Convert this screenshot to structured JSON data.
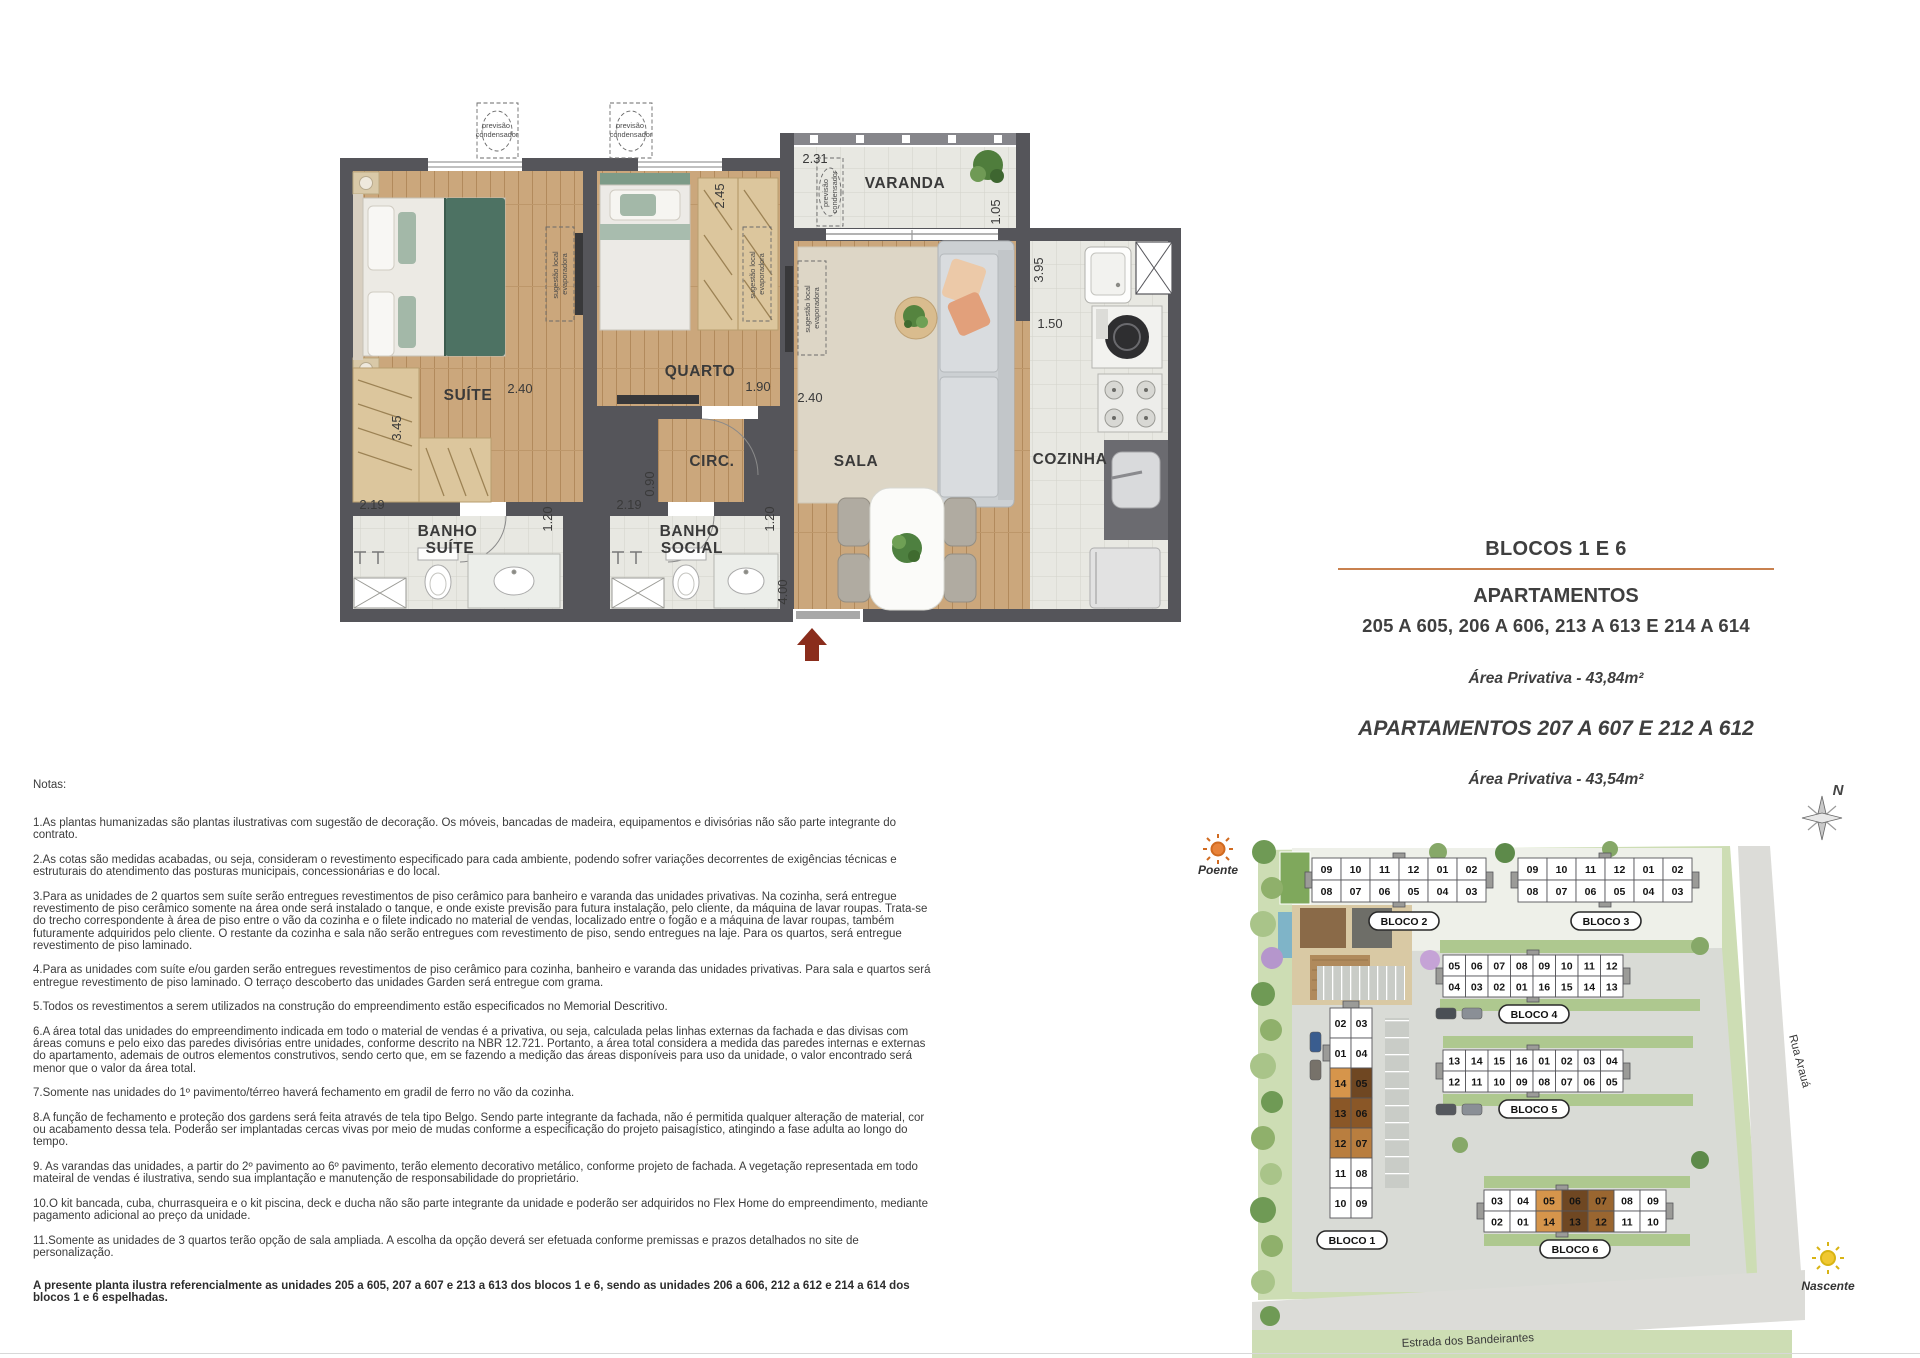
{
  "floorplan": {
    "rooms": {
      "suite": "SUÍTE",
      "quarto": "QUARTO",
      "circ": "CIRC.",
      "sala": "SALA",
      "cozinha": "COZINHA",
      "varanda": "VARANDA",
      "banho_suite": [
        "BANHO",
        "SUÍTE"
      ],
      "banho_social": [
        "BANHO",
        "SOCIAL"
      ]
    },
    "dims": {
      "varanda_width": "2.31",
      "varanda_depth": "1.05",
      "cozinha_depth": "3.95",
      "cozinha_width": "1.50",
      "quarto_depth": "2.45",
      "suite_width": "2.40",
      "suite_depth": "3.45",
      "quarto_width": "1.90",
      "sala_width": "2.40",
      "circ_width": "0.90",
      "banho_suite_width": "2.19",
      "banho_suite_depth": "1.20",
      "banho_social_width": "2.19",
      "banho_social_depth": "1.20",
      "sala_depth": "4.00"
    },
    "annotations": {
      "condenser": [
        "previsão",
        "condensador"
      ],
      "evaporator": [
        "sugestão local",
        "evaporadora"
      ]
    }
  },
  "title_block": {
    "line1": "BLOCOS 1 E 6",
    "line2": "APARTAMENTOS",
    "line3": "205 A 605, 206 A 606, 213 A 613 E 214 A 614",
    "area1": "Área Privativa - 43,84m²",
    "line4": "APARTAMENTOS 207 A 607 E 212 A 612",
    "area2": "Área Privativa - 43,54m²",
    "rule_color": "#C8814F"
  },
  "notes": {
    "heading": "Notas:",
    "items": [
      "1.As plantas humanizadas são plantas ilustrativas com sugestão de decoração. Os móveis, bancadas de madeira, equipamentos e divisórias não são parte integrante do contrato.",
      "2.As cotas são medidas acabadas, ou seja, consideram o revestimento especificado para cada ambiente, podendo sofrer variações decorrentes de exigências técnicas e estruturais do atendimento das posturas municipais, concessionárias e do local.",
      "3.Para as unidades de 2 quartos sem suíte serão entregues revestimentos de piso cerâmico para banheiro e varanda das unidades privativas. Na cozinha, será entregue revestimento de piso cerâmico somente na área onde será instalado o tanque, e onde existe previsão para futura instalação, pelo cliente, da máquina de lavar roupas. Trata-se do trecho correspondente à área de piso entre o vão da cozinha e o filete indicado no material de vendas, localizado entre o fogão e a máquina de lavar roupas, também futuramente adquiridos pelo cliente. O restante da cozinha e sala não serão entregues com revestimento de piso, sendo entregues na laje. Para os quartos, será entregue revestimento de piso laminado.",
      "4.Para as unidades com suíte e/ou garden serão entregues revestimentos de piso cerâmico para cozinha, banheiro e varanda das unidades privativas. Para sala e quartos será entregue revestimento de piso laminado. O terraço descoberto das unidades Garden será entregue com grama.",
      "5.Todos os revestimentos a serem utilizados na construção do empreendimento estão especificados no Memorial Descritivo.",
      "6.A área total das unidades do empreendimento indicada em todo o material de vendas é a privativa, ou seja, calculada pelas linhas externas da fachada e das divisas com áreas comuns e pelo eixo das paredes divisórias entre unidades, conforme descrito na NBR 12.721. Portanto, a área total considera a medida das paredes internas e externas do apartamento, ademais de outros elementos construtivos, sendo certo que, em se fazendo a medição das áreas disponíveis para uso da unidade, o valor encontrado será menor que o valor da área total.",
      "7.Somente nas unidades do 1º pavimento/térreo haverá fechamento em gradil de ferro no vão da cozinha.",
      "8.A função de fechamento e proteção dos gardens será feita através de tela tipo Belgo. Sendo parte integrante da fachada, não é permitida qualquer alteração de material, cor ou acabamento dessa tela. Poderão ser implantadas cercas vivas por meio de mudas conforme a especificação do projeto paisagístico, atingindo a fase adulta ao longo do tempo.",
      "9. As varandas das unidades, a partir do 2º pavimento ao 6º pavimento, terão elemento decorativo metálico, conforme projeto de fachada. A vegetação representada em todo mateiral de vendas é ilustrativa, sendo sua implantação e manutenção de responsabilidade do proprietário.",
      "10.O kit bancada, cuba, churrasqueira e o kit piscina, deck e ducha não são parte integrante da unidade e poderão ser adquiridos no Flex Home do empreendimento, mediante pagamento adicional ao preço da unidade.",
      "11.Somente as unidades de 3 quartos terão opção de sala ampliada. A escolha da opção deverá ser efetuada conforme premissas e prazos detalhados no site de personalização."
    ],
    "footer": "A presente planta ilustra referencialmente as unidades 205 a 605, 207 a 607 e 213 a 613 dos blocos 1 e 6, sendo as unidades 206 a 606, 212 a 612 e 214 a 614 dos blocos 1 e 6 espelhadas."
  },
  "siteplan": {
    "poente_label": "Poente",
    "nascente_label": "Nascente",
    "compass_label": "N",
    "road_bottom_label": "Estrada dos Bandeirantes",
    "road_right_label": "Rua Arauá",
    "highlight_colors": {
      "tan": "#D6954B",
      "dark": "#6F4722",
      "mid": "#9A6630",
      "light": "#B97E3F"
    },
    "blocks": [
      {
        "id": "bloco2",
        "label": "BLOCO 2",
        "orient": "h",
        "x": 1312,
        "y": 858,
        "cellw": 29,
        "cellh": 22,
        "core": 3,
        "lx": 1404,
        "ly": 921,
        "rows": [
          [
            "09",
            "10",
            "11",
            "12",
            "01",
            "02"
          ],
          [
            "08",
            "07",
            "06",
            "05",
            "04",
            "03"
          ]
        ],
        "highlights": {}
      },
      {
        "id": "bloco3",
        "label": "BLOCO 3",
        "orient": "h",
        "x": 1518,
        "y": 858,
        "cellw": 29,
        "cellh": 22,
        "core": 3,
        "lx": 1606,
        "ly": 921,
        "rows": [
          [
            "09",
            "10",
            "11",
            "12",
            "01",
            "02"
          ],
          [
            "08",
            "07",
            "06",
            "05",
            "04",
            "03"
          ]
        ],
        "highlights": {}
      },
      {
        "id": "bloco4",
        "label": "BLOCO 4",
        "orient": "h",
        "x": 1443,
        "y": 955,
        "cellw": 22.5,
        "cellh": 21,
        "core": 4,
        "lx": 1534,
        "ly": 1014,
        "rows": [
          [
            "05",
            "06",
            "07",
            "08",
            "09",
            "10",
            "11",
            "12"
          ],
          [
            "04",
            "03",
            "02",
            "01",
            "16",
            "15",
            "14",
            "13"
          ]
        ],
        "highlights": {}
      },
      {
        "id": "bloco5",
        "label": "BLOCO 5",
        "orient": "h",
        "x": 1443,
        "y": 1050,
        "cellw": 22.5,
        "cellh": 21,
        "core": 4,
        "lx": 1534,
        "ly": 1109,
        "rows": [
          [
            "13",
            "14",
            "15",
            "16",
            "01",
            "02",
            "03",
            "04"
          ],
          [
            "12",
            "11",
            "10",
            "09",
            "08",
            "07",
            "06",
            "05"
          ]
        ],
        "highlights": {}
      },
      {
        "id": "bloco6",
        "label": "BLOCO 6",
        "orient": "h",
        "x": 1484,
        "y": 1190,
        "cellw": 26,
        "cellh": 21,
        "core": 3,
        "lx": 1575,
        "ly": 1249,
        "rows": [
          [
            "03",
            "04",
            "05",
            "06",
            "07",
            "08",
            "09"
          ],
          [
            "02",
            "01",
            "14",
            "13",
            "12",
            "11",
            "10"
          ]
        ],
        "highlights": {
          "05": "#D6954B",
          "06": "#6F4722",
          "07": "#9A6630",
          "14": "#D6954B",
          "13": "#6F4722",
          "12": "#9A6630"
        }
      },
      {
        "id": "bloco1",
        "label": "BLOCO 1",
        "orient": "v",
        "x": 1330,
        "y": 1008,
        "cellw": 21,
        "cellh": 30,
        "lx": 1352,
        "ly": 1240,
        "rows": [
          [
            "02",
            "03"
          ],
          [
            "01",
            "04"
          ],
          [
            "14",
            "05"
          ],
          [
            "13",
            "06"
          ],
          [
            "12",
            "07"
          ],
          [
            "11",
            "08"
          ],
          [
            "10",
            "09"
          ]
        ],
        "highlights": {
          "14": "#D6954B",
          "05": "#6F4722",
          "13": "#8A5727",
          "06": "#8A5727",
          "12": "#B97E3F",
          "07": "#B97E3F"
        }
      }
    ]
  }
}
